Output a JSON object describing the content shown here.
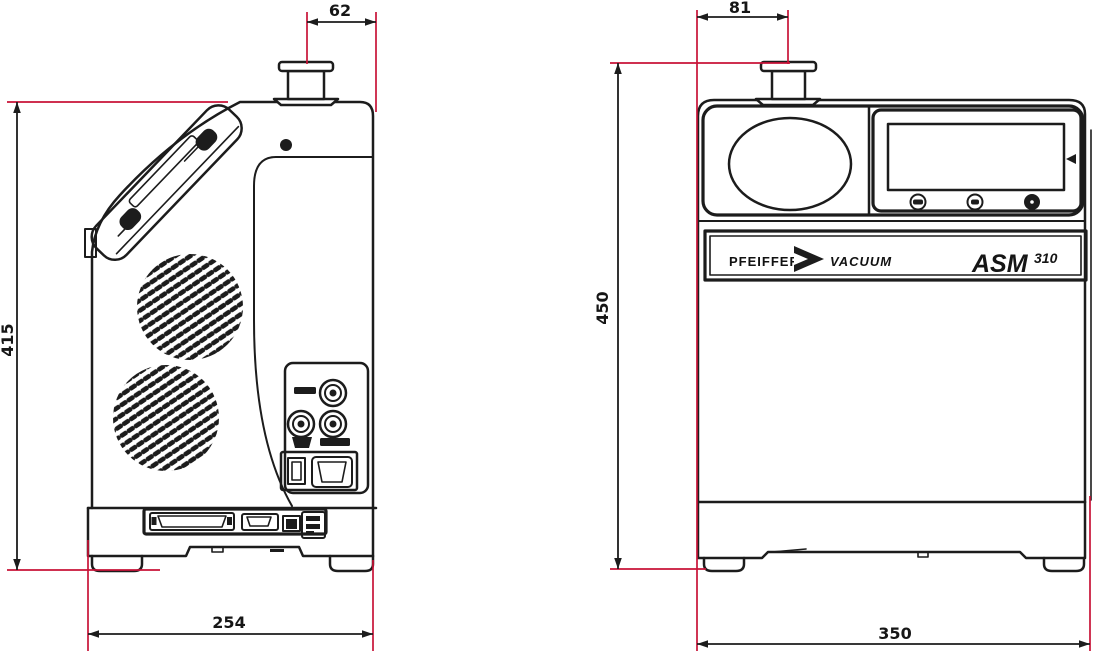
{
  "side_view": {
    "dim_flange_offset": "62",
    "dim_height": "415",
    "dim_depth": "254"
  },
  "front_view": {
    "dim_flange_offset": "81",
    "dim_height": "450",
    "dim_width": "350",
    "logo": {
      "brand_word_1": "PFEIFFER",
      "brand_word_2": "VACUUM",
      "model_name": "ASM",
      "model_number": "310"
    }
  },
  "colors": {
    "dimension_lines": "#c81237",
    "outlines": "#1c1c1c",
    "background": "#ffffff"
  }
}
